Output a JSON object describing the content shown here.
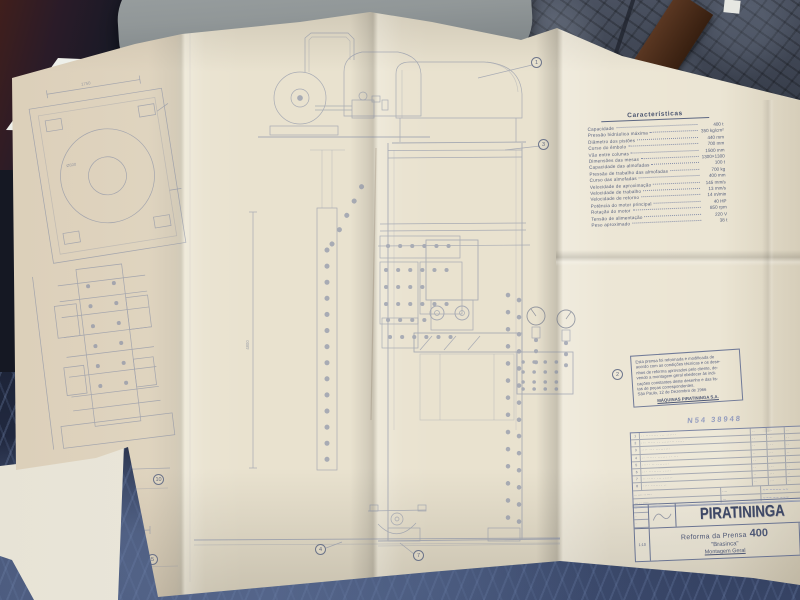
{
  "colors": {
    "paper": "#e9e2cf",
    "tiles": "#3d4451",
    "slab": "#919798",
    "wood": "#5a3722",
    "cloth": "#262f4a",
    "white_sheet": "#eef0ea",
    "ink": "#7d87a2",
    "ink_dark": "#55607c",
    "text": "#555f7d",
    "stamp": "#5a6db2"
  },
  "characteristics": {
    "title": "Características",
    "rows": [
      {
        "label": "Capacidade",
        "value": "400 t"
      },
      {
        "label": "Pressão hidráulica máxima",
        "value": "350 kg/cm²"
      },
      {
        "label": "Diâmetro dos pistões",
        "value": "440 mm"
      },
      {
        "label": "Curso do êmbolo",
        "value": "700 mm"
      },
      {
        "label": "Vão entre colunas",
        "value": "1500 mm"
      },
      {
        "label": "Dimensões das mesas",
        "value": "1300×1300"
      },
      {
        "label": "Capacidade das almofadas",
        "value": "100 t"
      },
      {
        "label": "Pressão de trabalho das almofadas",
        "value": "700 kg"
      },
      {
        "label": "Curso das almofadas",
        "value": "400 mm"
      },
      {
        "label": "Velocidade de aproximação",
        "value": "145 mm/s"
      },
      {
        "label": "Velocidade de trabalho",
        "value": "13 mm/s"
      },
      {
        "label": "Velocidade de retorno",
        "value": "14 m/min"
      },
      {
        "label": "Potência do motor principal",
        "value": "40 HP"
      },
      {
        "label": "Rotação do motor",
        "value": "850 rpm"
      },
      {
        "label": "Tensão de alimentação",
        "value": "220 V"
      },
      {
        "label": "Peso aproximado",
        "value": "38 t"
      }
    ]
  },
  "note": {
    "lines": [
      "Esta prensa foi reformada e modificada de",
      "acordo com as condições técnicas e os dese-",
      "nhos de reforma aprovados pelo cliente, de-",
      "vendo a montagem geral obedecer às indi-",
      "cações constantes deste desenho e das lis-",
      "tas de peças correspondentes.",
      "São Paulo, 12 de Dezembro de 1966"
    ],
    "signature": "MÁQUINAS PIRATININGA S.A."
  },
  "stamp": {
    "text": "N54 38948"
  },
  "parts_table": {
    "rows": [
      {
        "n": "1",
        "d": "·· ········ ··· ······",
        "m1": "··",
        "m2": "···",
        "m3": "··"
      },
      {
        "n": "2",
        "d": "··· ····· ·· ········ ·····",
        "m1": "··",
        "m2": "···",
        "m3": "··"
      },
      {
        "n": "3",
        "d": "···· ··· ·········",
        "m1": "··",
        "m2": "···",
        "m3": "··"
      },
      {
        "n": "4",
        "d": "·· ······ ······ ·· ···",
        "m1": "··",
        "m2": "···",
        "m3": "··"
      },
      {
        "n": "5",
        "d": "····· ·· ········",
        "m1": "··",
        "m2": "···",
        "m3": "··"
      },
      {
        "n": "6",
        "d": "··· ········ ·····",
        "m1": "··",
        "m2": "···",
        "m3": "··"
      },
      {
        "n": "7",
        "d": "·· ····· ··· ······",
        "m1": "··",
        "m2": "···",
        "m3": "··"
      },
      {
        "n": "8",
        "d": "···· ······· ··",
        "m1": "··",
        "m2": "···",
        "m3": "··"
      }
    ],
    "admin_rows": [
      {
        "l": "·· ···· ·· ····",
        "m": "····",
        "r": "∼∼ ∼∼∼∼ ∼∼"
      },
      {
        "l": "··· ·· ·····",
        "m": "···",
        "r": "∼∼∼ ∼∼ ∼∼∼"
      }
    ]
  },
  "title_block": {
    "company": "PIRATININGA",
    "project": "Reforma da Prensa",
    "tonnage": "400",
    "client": "\"Brasinca\"",
    "subtitle": "Montagem Geral",
    "scale": "1:10",
    "approvals": [
      "··",
      "··",
      "··"
    ]
  },
  "drawing": {
    "callouts": {
      "c1": "1",
      "c2": "2",
      "c3": "3",
      "c4": "4",
      "c5": "5",
      "c7": "7",
      "c10": "10"
    },
    "dims": {
      "top_left": "1750",
      "bore": "Ø500",
      "left_height": "4115",
      "mid_height": "4800",
      "base_width": "340"
    }
  }
}
